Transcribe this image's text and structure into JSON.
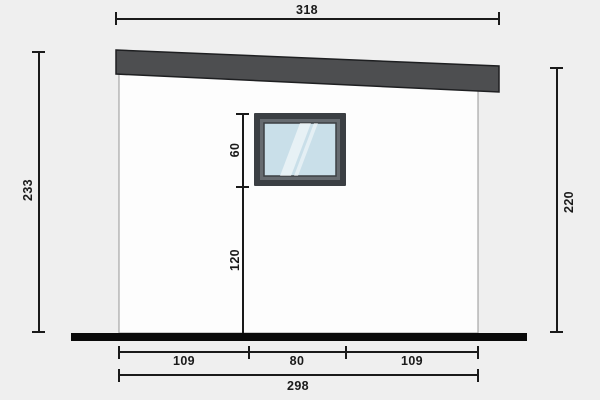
{
  "diagram": {
    "title": "Building side elevation with dimensions",
    "dimensions": {
      "roof_span": "318",
      "left_total_height": "233",
      "right_wall_height": "220",
      "window_height": "60",
      "window_sill_height": "120",
      "bottom_segments": [
        "109",
        "80",
        "109"
      ],
      "wall_total_width": "298"
    },
    "colors": {
      "background": "#efefef",
      "wall_fill": "#fdfdfd",
      "wall_border": "#969696",
      "roof_fill": "#4d4e50",
      "roof_border": "#1e1f21",
      "window_frame_outer": "#3b3f43",
      "window_frame_inner": "#666b70",
      "glass_fill": "#c9dfe9",
      "glass_reflection": "#ffffff",
      "ground_fill": "#0a0a0a",
      "dimension_color": "#1a1a1a"
    }
  }
}
